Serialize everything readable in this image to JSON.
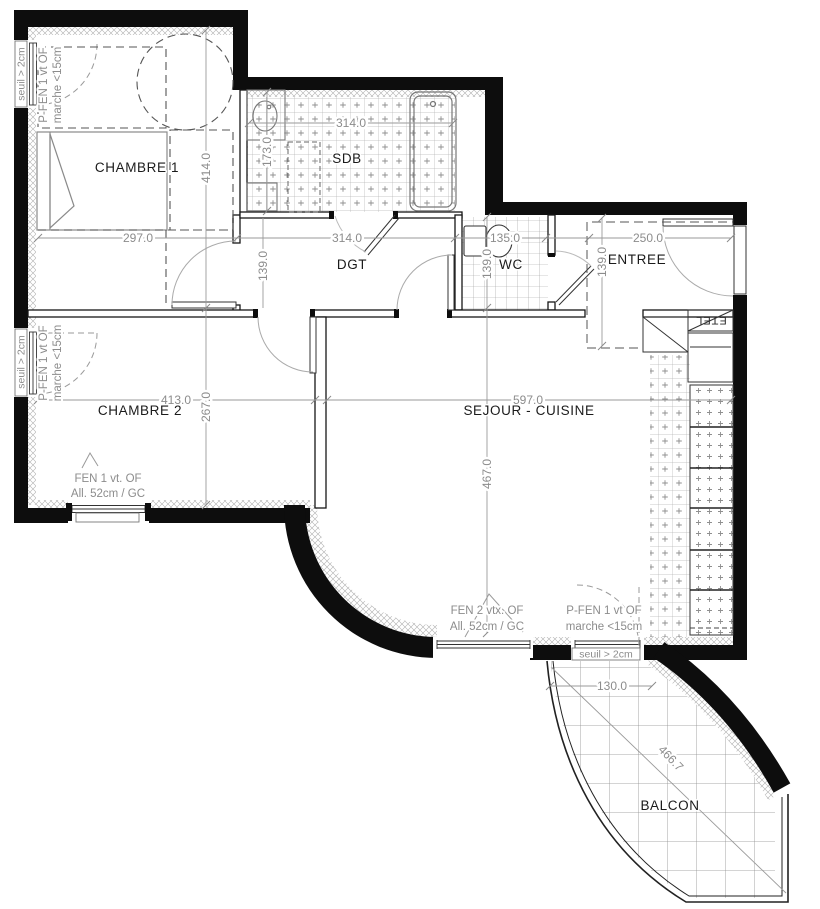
{
  "drawing": {
    "rooms": [
      {
        "id": "chambre1",
        "label": "CHAMBRE 1",
        "dim_w": "297.0",
        "dim_h": "414.0"
      },
      {
        "id": "sdb",
        "label": "SDB",
        "dim_w": "314.0",
        "dim_h": "173.0"
      },
      {
        "id": "dgt",
        "label": "DGT",
        "dim_w": "314.0",
        "dim_h": "139.0"
      },
      {
        "id": "wc",
        "label": "WC",
        "dim_w": "135.0",
        "dim_h": "139.0"
      },
      {
        "id": "entree",
        "label": "ENTREE",
        "dim_w": "250.0",
        "dim_h": "139.0"
      },
      {
        "id": "chambre2",
        "label": "CHAMBRE 2",
        "dim_w": "413.0",
        "dim_h": "267.0"
      },
      {
        "id": "sejour",
        "label": "SEJOUR - CUISINE",
        "dim_w": "597.0",
        "dim_h": "467.0"
      },
      {
        "id": "balcon",
        "label": "BALCON",
        "dim_w": "130.0",
        "dim_diag": "466.7"
      }
    ],
    "annotations": {
      "win_ch1": {
        "l1": "P-FEN 1 vt OF",
        "l2": "marche <15cm",
        "sill": "seuil > 2cm"
      },
      "win_ch2": {
        "l1": "P-FEN 1 vt OF",
        "l2": "marche <15cm",
        "sill": "seuil > 2cm"
      },
      "fen_ch2": {
        "l1": "FEN 1 vt. OF",
        "l2": "All. 52cm / GC"
      },
      "fen_sejour": {
        "l1": "FEN 2 vtx. OF",
        "l2": "All. 52cm / GC"
      },
      "pfen_balcon": {
        "l1": "P-FEN 1 vt OF",
        "l2": "marche <15cm",
        "sill": "seuil > 2cm"
      },
      "etel": "ETEL"
    }
  }
}
